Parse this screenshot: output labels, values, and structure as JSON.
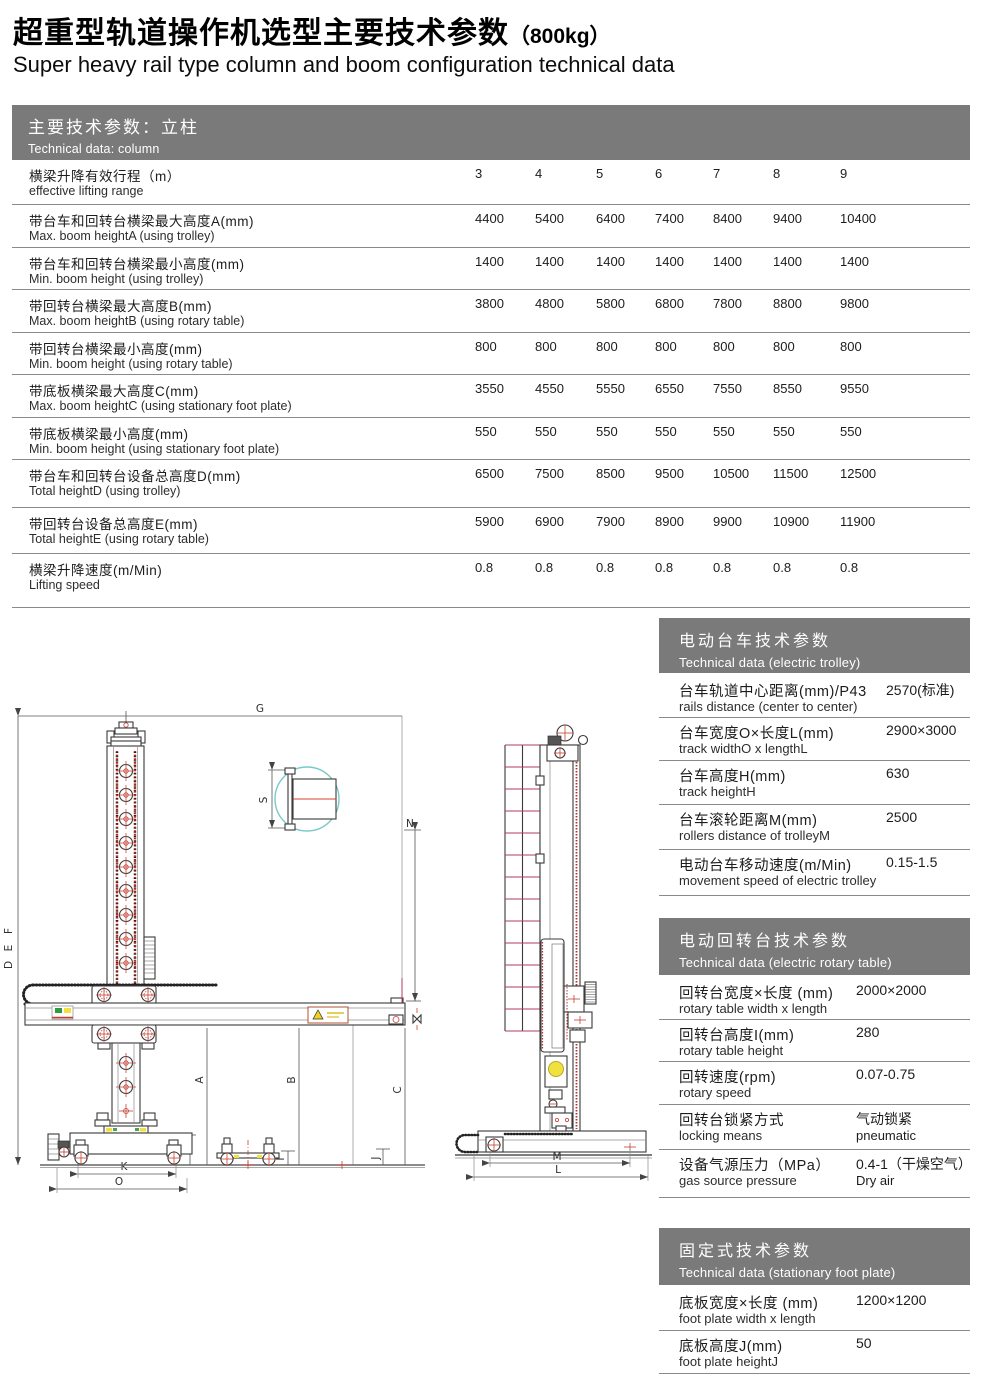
{
  "page": {
    "title_zh": "超重型轨道操作机选型主要技术参数",
    "title_suffix": "（800kg）",
    "title_en": "Super heavy rail type column and boom configuration technical data"
  },
  "column_table": {
    "header_zh": "主要技术参数：立柱",
    "header_en": "Technical data: column",
    "rows": [
      {
        "zh": "横梁升降有效行程（m）",
        "en": "effective lifting range",
        "values": [
          "3",
          "4",
          "5",
          "6",
          "7",
          "8",
          "9"
        ]
      },
      {
        "zh": "带台车和回转台横梁最大高度A(mm)",
        "en": "Max. boom heightA (using trolley)",
        "values": [
          "4400",
          "5400",
          "6400",
          "7400",
          "8400",
          "9400",
          "10400"
        ]
      },
      {
        "zh": "带台车和回转台横梁最小高度(mm)",
        "en": "Min. boom height (using trolley)",
        "values": [
          "1400",
          "1400",
          "1400",
          "1400",
          "1400",
          "1400",
          "1400"
        ]
      },
      {
        "zh": "带回转台横梁最大高度B(mm)",
        "en": "Max. boom heightB (using rotary table)",
        "values": [
          "3800",
          "4800",
          "5800",
          "6800",
          "7800",
          "8800",
          "9800"
        ]
      },
      {
        "zh": "带回转台横梁最小高度(mm)",
        "en": "Min. boom height (using rotary table)",
        "values": [
          "800",
          "800",
          "800",
          "800",
          "800",
          "800",
          "800"
        ]
      },
      {
        "zh": "带底板横梁最大高度C(mm)",
        "en": "Max. boom heightC (using stationary foot plate)",
        "values": [
          "3550",
          "4550",
          "5550",
          "6550",
          "7550",
          "8550",
          "9550"
        ]
      },
      {
        "zh": "带底板横梁最小高度(mm)",
        "en": "Min. boom height (using stationary foot plate)",
        "values": [
          "550",
          "550",
          "550",
          "550",
          "550",
          "550",
          "550"
        ]
      },
      {
        "zh": "带台车和回转台设备总高度D(mm)",
        "en": "Total heightD (using trolley)",
        "values": [
          "6500",
          "7500",
          "8500",
          "9500",
          "10500",
          "11500",
          "12500"
        ]
      },
      {
        "zh": "带回转台设备总高度E(mm)",
        "en": "Total heightE (using rotary table)",
        "values": [
          "5900",
          "6900",
          "7900",
          "8900",
          "9900",
          "10900",
          "11900"
        ]
      },
      {
        "zh": "横梁升降速度(m/Min)",
        "en": "Lifting speed",
        "values": [
          "0.8",
          "0.8",
          "0.8",
          "0.8",
          "0.8",
          "0.8",
          "0.8"
        ]
      }
    ]
  },
  "trolley_table": {
    "header_zh": "电动台车技术参数",
    "header_en": "Technical data (electric trolley)",
    "rows": [
      {
        "zh": "台车轨道中心距离(mm)/P43",
        "en": "rails distance (center to center)",
        "value": "2570(标准)"
      },
      {
        "zh": "台车宽度O×长度L(mm)",
        "en": "track widthO x lengthL",
        "value": "2900×3000"
      },
      {
        "zh": "台车高度H(mm)",
        "en": "track heightH",
        "value": "630"
      },
      {
        "zh": "台车滚轮距离M(mm)",
        "en": "rollers distance of trolleyM",
        "value": "2500"
      },
      {
        "zh": "电动台车移动速度(m/Min)",
        "en": "movement speed of electric trolley",
        "value": "0.15-1.5"
      }
    ]
  },
  "rotary_table": {
    "header_zh": "电动回转台技术参数",
    "header_en": "Technical data (electric rotary table)",
    "rows": [
      {
        "zh": "回转台宽度×长度 (mm)",
        "en": "rotary table width x length",
        "value": "2000×2000"
      },
      {
        "zh": "回转台高度I(mm)",
        "en": "rotary table height",
        "value": "280"
      },
      {
        "zh": "回转速度(rpm)",
        "en": "rotary speed",
        "value": "0.07-0.75"
      },
      {
        "zh": "回转台锁紧方式",
        "en": "locking means",
        "value": "气动锁紧",
        "value2": "pneumatic"
      },
      {
        "zh": "设备气源压力（MPa）",
        "en": "gas source pressure",
        "value": "0.4-1（干燥空气）",
        "value2": "Dry air"
      }
    ]
  },
  "foot_table": {
    "header_zh": "固定式技术参数",
    "header_en": "Technical data (stationary foot plate)",
    "rows": [
      {
        "zh": "底板宽度×长度 (mm)",
        "en": "foot plate width x length",
        "value": "1200×1200"
      },
      {
        "zh": "底板高度J(mm)",
        "en": "foot plate heightJ",
        "value": "50"
      }
    ]
  },
  "drawing": {
    "labels": {
      "g": "G",
      "f": "F",
      "e": "E",
      "d": "D",
      "s": "S",
      "n": "N",
      "a": "A",
      "b": "B",
      "c": "C",
      "h": "H",
      "k": "K",
      "o": "O",
      "i": "I",
      "j": "J",
      "m": "M",
      "l": "L"
    }
  }
}
